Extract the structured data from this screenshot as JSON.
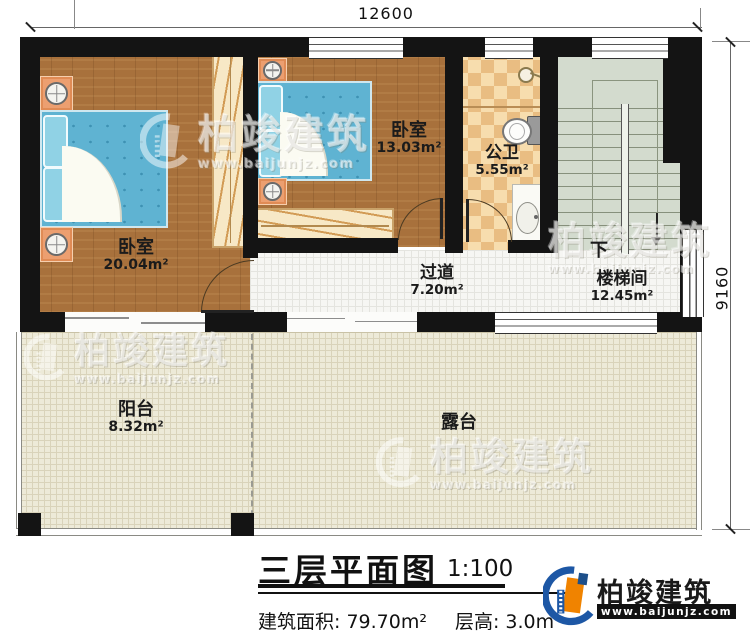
{
  "plan": {
    "dimensions": {
      "width_mm": "12600",
      "height_mm": "9160"
    },
    "rooms": [
      {
        "name": "卧室",
        "area": "20.04m²"
      },
      {
        "name": "卧室",
        "area": "13.03m²"
      },
      {
        "name": "公卫",
        "area": "5.55m²"
      },
      {
        "name": "过道",
        "area": "7.20m²"
      },
      {
        "name": "楼梯间",
        "area": "12.45m²"
      },
      {
        "name": "阳台",
        "area": "8.32m²"
      },
      {
        "name": "露台",
        "area": ""
      }
    ],
    "stairs": {
      "direction_label": "下"
    }
  },
  "title_block": {
    "title": "三层平面图",
    "scale": "1:100",
    "building_area_label": "建筑面积: 79.70m²",
    "floor_height_label": "层高: 3.0m"
  },
  "brand": {
    "name": "柏竣建筑",
    "url": "www.baijunjz.com"
  },
  "watermark": {
    "name": "柏竣建筑",
    "url": "www.baijunjz.com"
  },
  "palette": {
    "wall": "#141414",
    "wood_floor": "#a8713c",
    "bed_blue": "#5fb3d2",
    "pillow_blue": "#90d2e5",
    "corridor_tile": "#f6f6f3",
    "bath_check_light": "#f7ddae",
    "bath_check_dark": "#e9bd82",
    "stair_floor": "#d3dbce",
    "outdoor_floor": "#edead8",
    "nightstand": "#ec9f70",
    "wardrobe": "#f7e8c6",
    "brand_blue": "#1d57a5",
    "brand_orange": "#f08300"
  }
}
